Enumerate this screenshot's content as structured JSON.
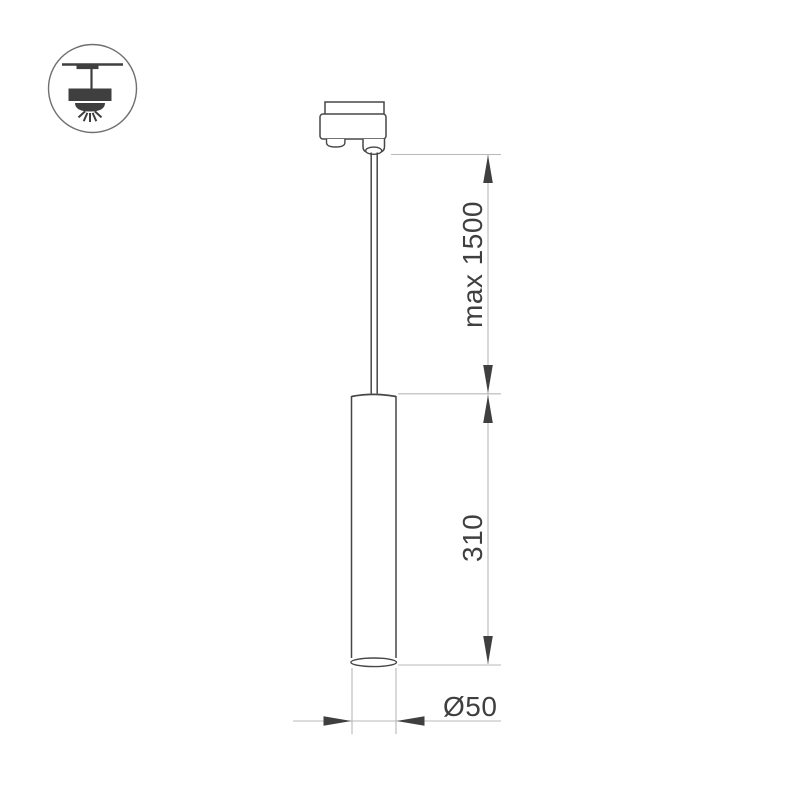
{
  "page": {
    "kind": "product dimension drawing",
    "background": "#ffffff"
  },
  "badge": {
    "icon": "pendant-lamp-icon",
    "meaning": "suspended ceiling luminaire"
  },
  "drawing": {
    "labels": {
      "suspension_length": "max 1500",
      "body_height": "310",
      "body_diameter": "Ø50"
    },
    "colors": {
      "outline_dark": "#474747",
      "dimension_light": "#b9b9b9",
      "arrow": "#3f3f3f",
      "text": "#3f3f3f",
      "background": "#ffffff"
    }
  }
}
